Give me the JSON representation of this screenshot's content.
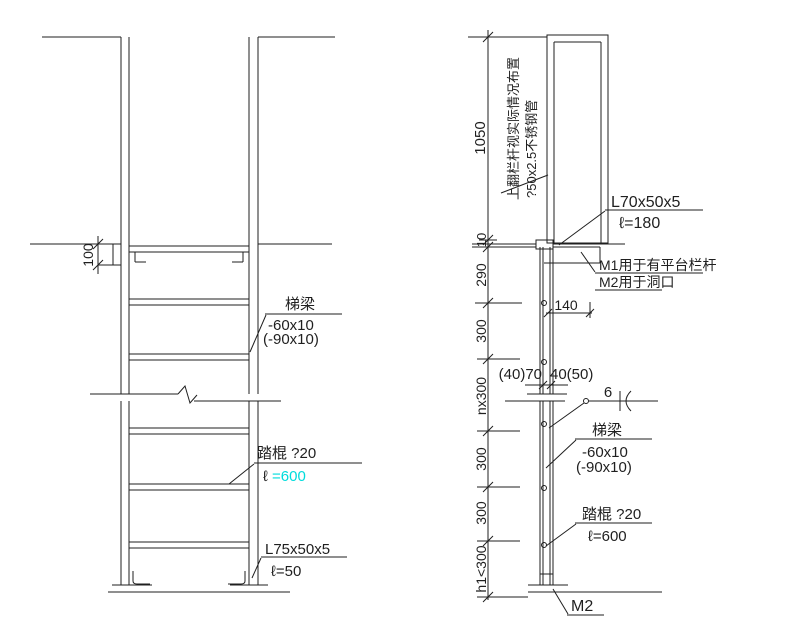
{
  "colors": {
    "line": "#1f1f1f",
    "highlight_cyan": "#00dcdc",
    "background": "#ffffff"
  },
  "front_view": {
    "embed_dim": "100",
    "beam_callout": {
      "title": "梯梁",
      "size": "-60x10",
      "alt_size": "(-90x10)"
    },
    "rung_callout": {
      "title": "踏棍 ?20",
      "len_prefix": "ℓ ",
      "len_value": "=600"
    },
    "base_angle_callout": {
      "size": "L75x50x5",
      "length": "ℓ=50"
    }
  },
  "side_view": {
    "dims": [
      "1050",
      "10",
      "290",
      "300",
      "nx300",
      "300",
      "300",
      "h1<300"
    ],
    "dim_140": "140",
    "hole_dim_left": "(40)70",
    "hole_dim_right": "40(50)",
    "weld_size": "6",
    "handrail_note": {
      "line1": "上翻栏杆视实际情况布置",
      "line2": "?50x2.5不锈钢管"
    },
    "top_angle_callout": {
      "size": "L70x50x5",
      "length": "ℓ=180"
    },
    "anchor_note": {
      "line1": "M1用于有平台栏杆",
      "line2": "M2用于洞口"
    },
    "beam_callout": {
      "title": "梯梁",
      "size": "-60x10",
      "alt_size": "(-90x10)"
    },
    "rung_callout": {
      "title": "踏棍 ?20",
      "length": "ℓ=600"
    },
    "base_mark": "M2"
  }
}
